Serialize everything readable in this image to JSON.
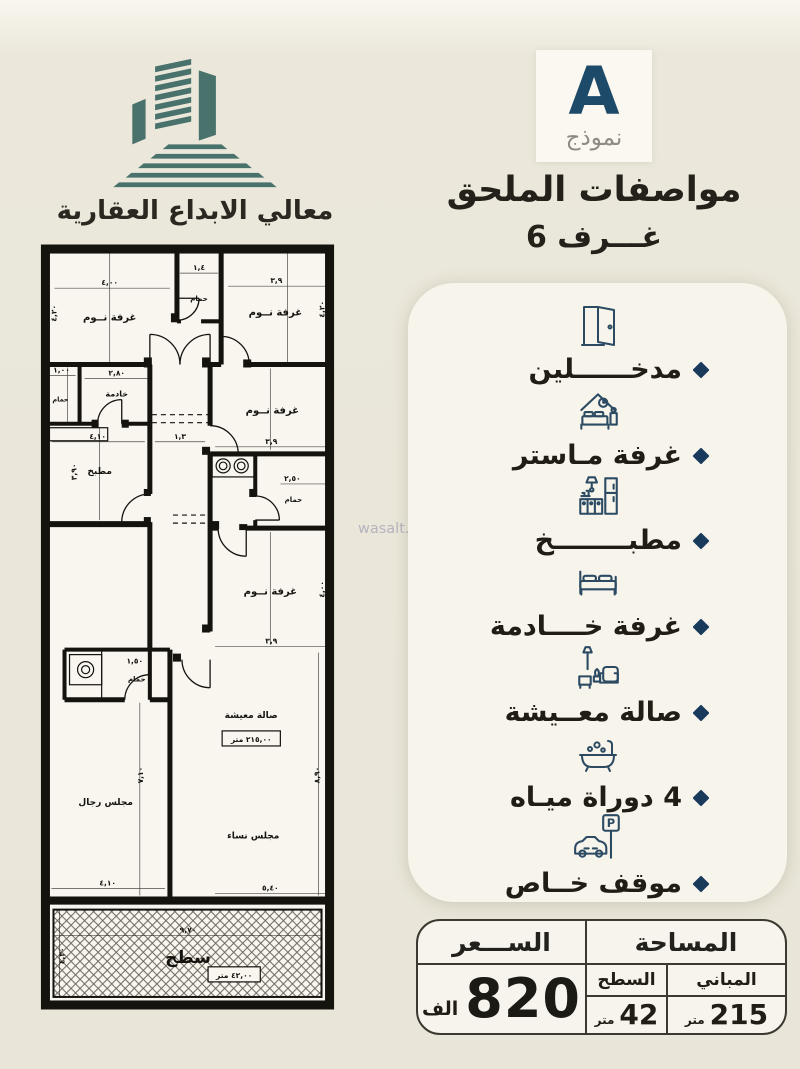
{
  "brand": {
    "company_name": "معالي الابداع العقارية"
  },
  "header": {
    "model_letter": "A",
    "model_word": "نموذج",
    "title": "مواصفات الملحق",
    "rooms_count": "6 غـــرف"
  },
  "watermark": {
    "text": "wasalt.com"
  },
  "features": {
    "items": [
      {
        "icon": "door-icon",
        "label": "مدخــــــلين"
      },
      {
        "icon": "master-bedroom-icon",
        "label": "غرفة مـاستر"
      },
      {
        "icon": "kitchen-icon",
        "label": "مطبــــــــخ"
      },
      {
        "icon": "maid-room-bed-icon",
        "label": "غرفة خــــادمة"
      },
      {
        "icon": "living-room-icon",
        "label": "صالة معــيشة"
      },
      {
        "icon": "bathtub-icon",
        "label": "4 دوراة ميـاه"
      },
      {
        "icon": "parking-icon",
        "label": "موقف خــاص"
      }
    ],
    "parking_sign_letter": "P"
  },
  "pricing": {
    "price_header": "الســـعر",
    "price_value": "820",
    "price_unit": "الف",
    "area_header": "المساحة",
    "roof_col": {
      "label": "السطح",
      "value": "42",
      "unit": "متر"
    },
    "buildings_col": {
      "label": "المباني",
      "value": "215",
      "unit": "متر"
    }
  },
  "plan": {
    "rooms": {
      "bedroom_top_left": "غرفة نــوم",
      "bath_top": "حمام",
      "bedroom_top_right": "غرفة نــوم",
      "maid_room": "خادمة",
      "bath_maid": "حمام",
      "kitchen": "مطبخ",
      "bedroom_mid_right": "غرفة نــوم",
      "bath_mid": "حمام",
      "bedroom_lower_right": "غرفة نــوم",
      "bath_lower": "حمام",
      "living_hall": "صالة معيشة",
      "living_area_box": "٢١٥,٠٠ متر",
      "men_majlis": "مجلس رجال",
      "women_majlis": "مجلس نساء",
      "roof": "سطح",
      "roof_area_box": "٤٢,٠٠ متر"
    },
    "dims": {
      "bedroom_top_left_w": "٤,٠٠",
      "bedroom_top_left_h": "٤,٢٠",
      "bath_top_w": "١,٤",
      "bedroom_top_right_w": "٣,٩",
      "bedroom_top_right_h": "٤,٢٠",
      "maid_w": "٢,٨٠",
      "bath_maid_w": "١,٠٠",
      "kitchen_w": "٤,١٠",
      "kitchen_h": "٣,٩٠",
      "corridor_w": "١,٣",
      "bedroom_mid_right_w": "٣,٩",
      "bath_mid_w": "٢,٥٠",
      "bedroom_lower_right_w": "٣,٩",
      "bedroom_lower_right_h": "٤,٠٠",
      "bath_lower_w": "١,٥٠",
      "men_majlis_w": "٤,١٠",
      "men_majlis_h": "٧,١٠",
      "women_majlis_w": "٥,٤٠",
      "right_side_h": "٨,٩٠",
      "roof_w": "٩,٧٠",
      "roof_h": "٤,٣٠"
    }
  },
  "colors": {
    "accent_navy": "#1d4a69",
    "bullet_navy": "#1a3a5c",
    "logo_teal": "#4a726c",
    "ink": "#1f1d18",
    "card_bg": "#f7f4ec",
    "page_bg": "#e9e6d9"
  }
}
